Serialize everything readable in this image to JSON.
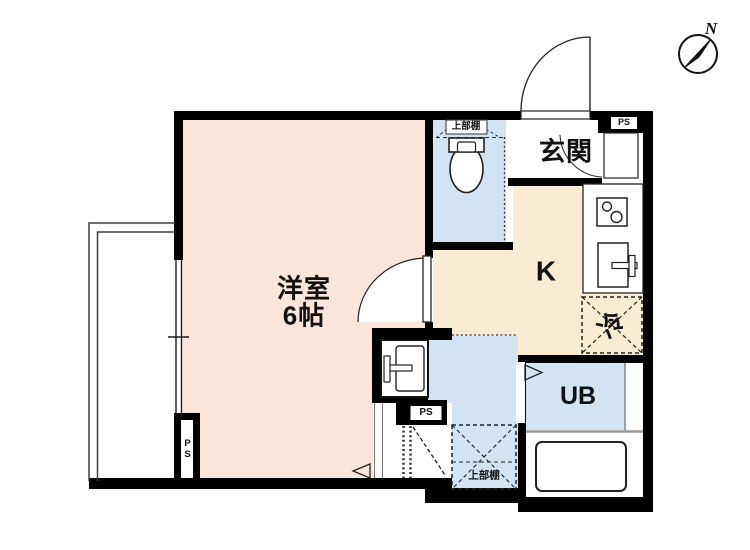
{
  "floorplan": {
    "type": "japanese-apartment-floor-plan",
    "compass": {
      "north_label": "N"
    },
    "rooms": {
      "western_room": {
        "name": "洋室",
        "size": "6帖"
      },
      "kitchen": {
        "label": "K"
      },
      "entrance": {
        "label": "玄関"
      },
      "unit_bath": {
        "label": "UB"
      },
      "refrigerator": {
        "label": "冷"
      },
      "toilet_upper_shelf": {
        "label": "上部棚"
      },
      "washroom_upper_shelf": {
        "label": "上部棚"
      },
      "pipe_space_entrance": {
        "label": "PS"
      },
      "pipe_space_washroom": {
        "label": "PS"
      },
      "pipe_space_balcony": {
        "label": "PS"
      }
    },
    "colors": {
      "western_room_floor": "#fbe5da",
      "kitchen_floor": "#f9ecd2",
      "wet_area_floor": "#d2e4f4",
      "wall": "#000000",
      "background": "#ffffff"
    }
  }
}
